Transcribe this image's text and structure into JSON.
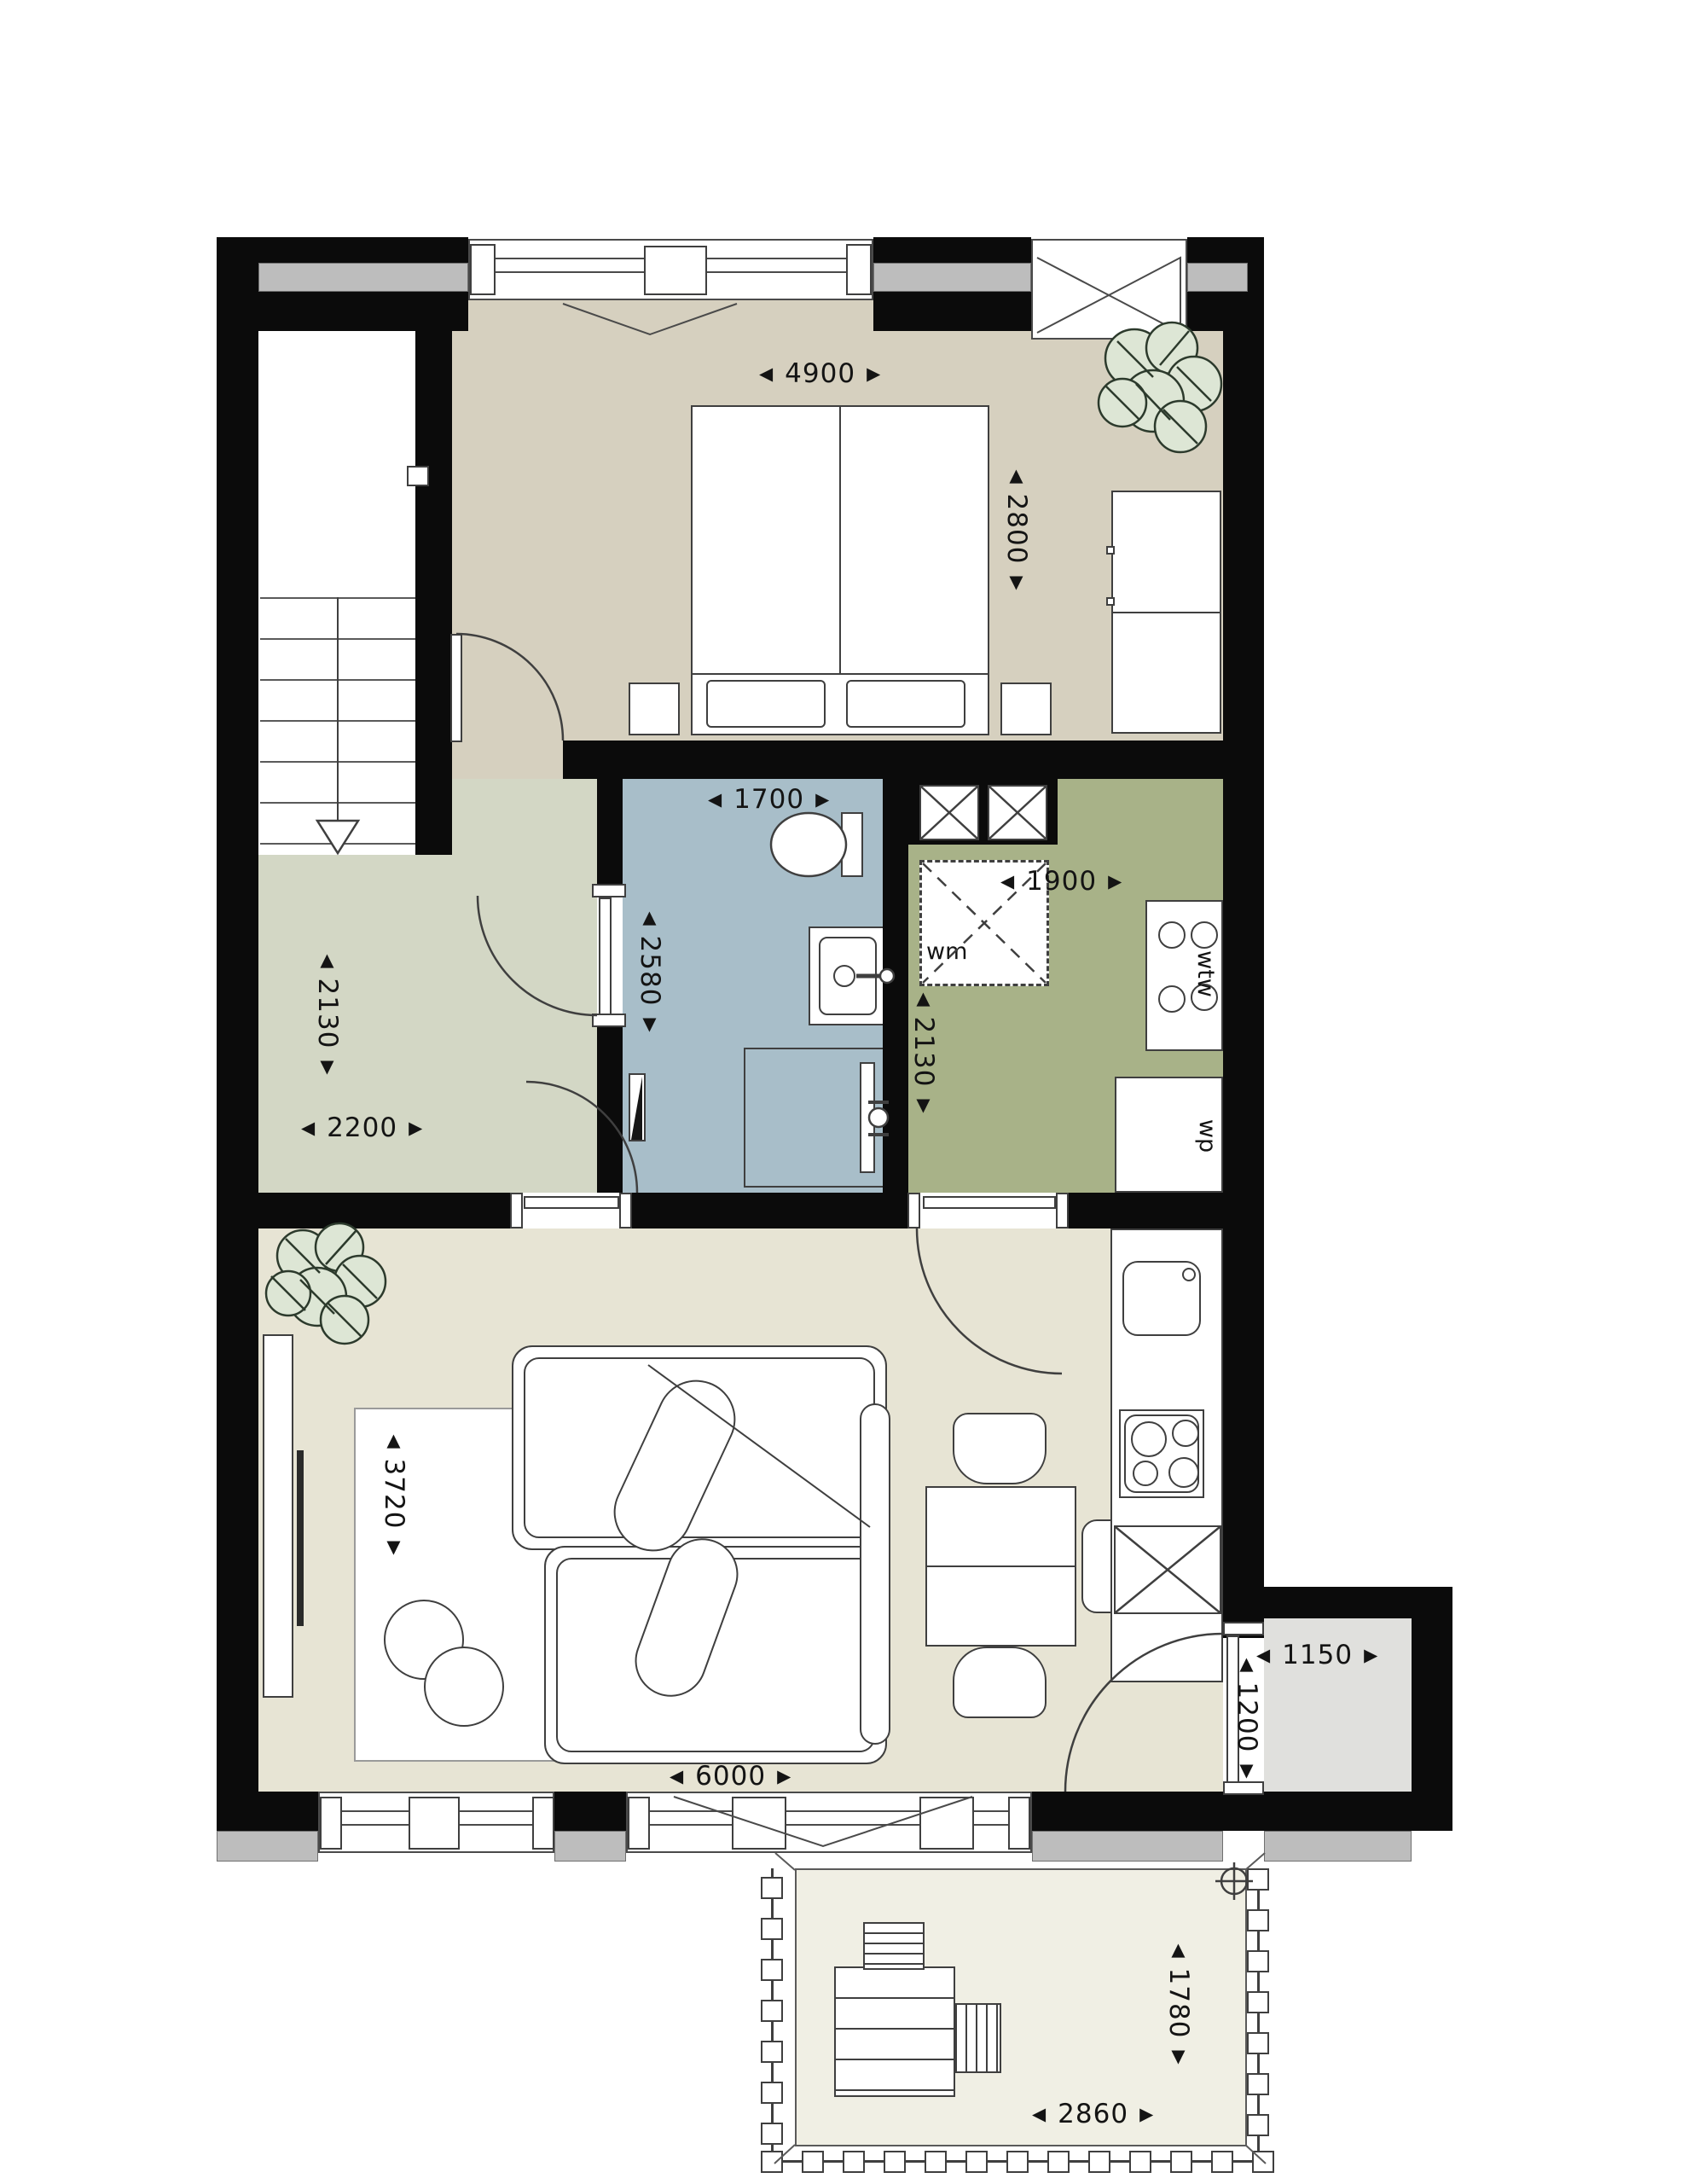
{
  "arrows": {
    "l": "◀",
    "r": "▶",
    "u": "▲",
    "d": "▼"
  },
  "colors": {
    "wall": "#0b0b0b",
    "bedroom_floor": "#d6d0bf",
    "hallway_floor": "#d3d7c5",
    "bathroom_floor": "#a8bec9",
    "utility_floor": "#a8b288",
    "living_floor": "#e7e4d4",
    "entry_nook_floor": "#e0e0dd",
    "terrace_floor": "#f0efe4",
    "window_sill": "#bdbdbd",
    "plant_leaf": "#dde6d5"
  },
  "dims": {
    "bedroom_w": "4900",
    "bedroom_d": "2800",
    "bathroom_w": "1700",
    "bathroom_d": "2580",
    "utility_w": "1900",
    "utility_d": "2130",
    "hall_d": "2130",
    "hall_w": "2200",
    "living_d": "3720",
    "living_w": "6000",
    "nook_w": "1150",
    "nook_d": "1200",
    "terrace_d": "1780",
    "terrace_w": "2860"
  },
  "appliances": {
    "wm": "wm",
    "wtw": "wtw",
    "wp": "wp"
  }
}
